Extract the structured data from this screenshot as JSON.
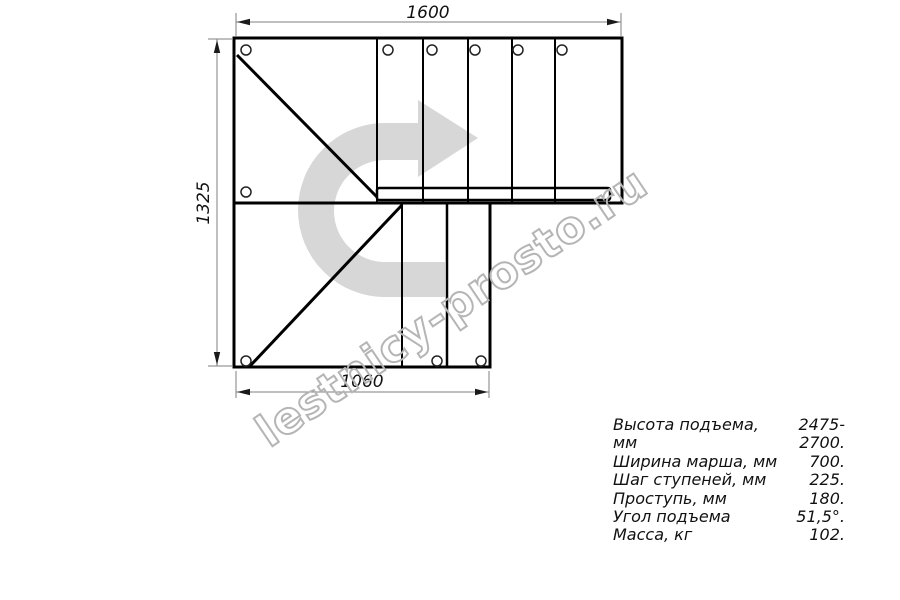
{
  "plan": {
    "dimensions": {
      "top_width_mm": "1600",
      "left_height_mm": "1325",
      "bottom_width_mm": "1060"
    }
  },
  "specs": {
    "rows": [
      {
        "label": "Высота подъема, мм",
        "value": "2475-2700."
      },
      {
        "label": "Ширина марша, мм",
        "value": "700."
      },
      {
        "label": "Шаг ступеней, мм",
        "value": "225."
      },
      {
        "label": "Проступь, мм",
        "value": "180."
      },
      {
        "label": "Угол подъема",
        "value": "51,5°."
      },
      {
        "label": "Масса, кг",
        "value": "102."
      }
    ]
  },
  "watermark": {
    "text": "lestnicy-prosto.ru"
  },
  "colors": {
    "drawing_line": "#000000",
    "dimension_line": "#7f7f7f",
    "direction_arrow_fill": "#d7d7d7",
    "watermark_outline": "#b5b5b5",
    "background": "#ffffff"
  }
}
